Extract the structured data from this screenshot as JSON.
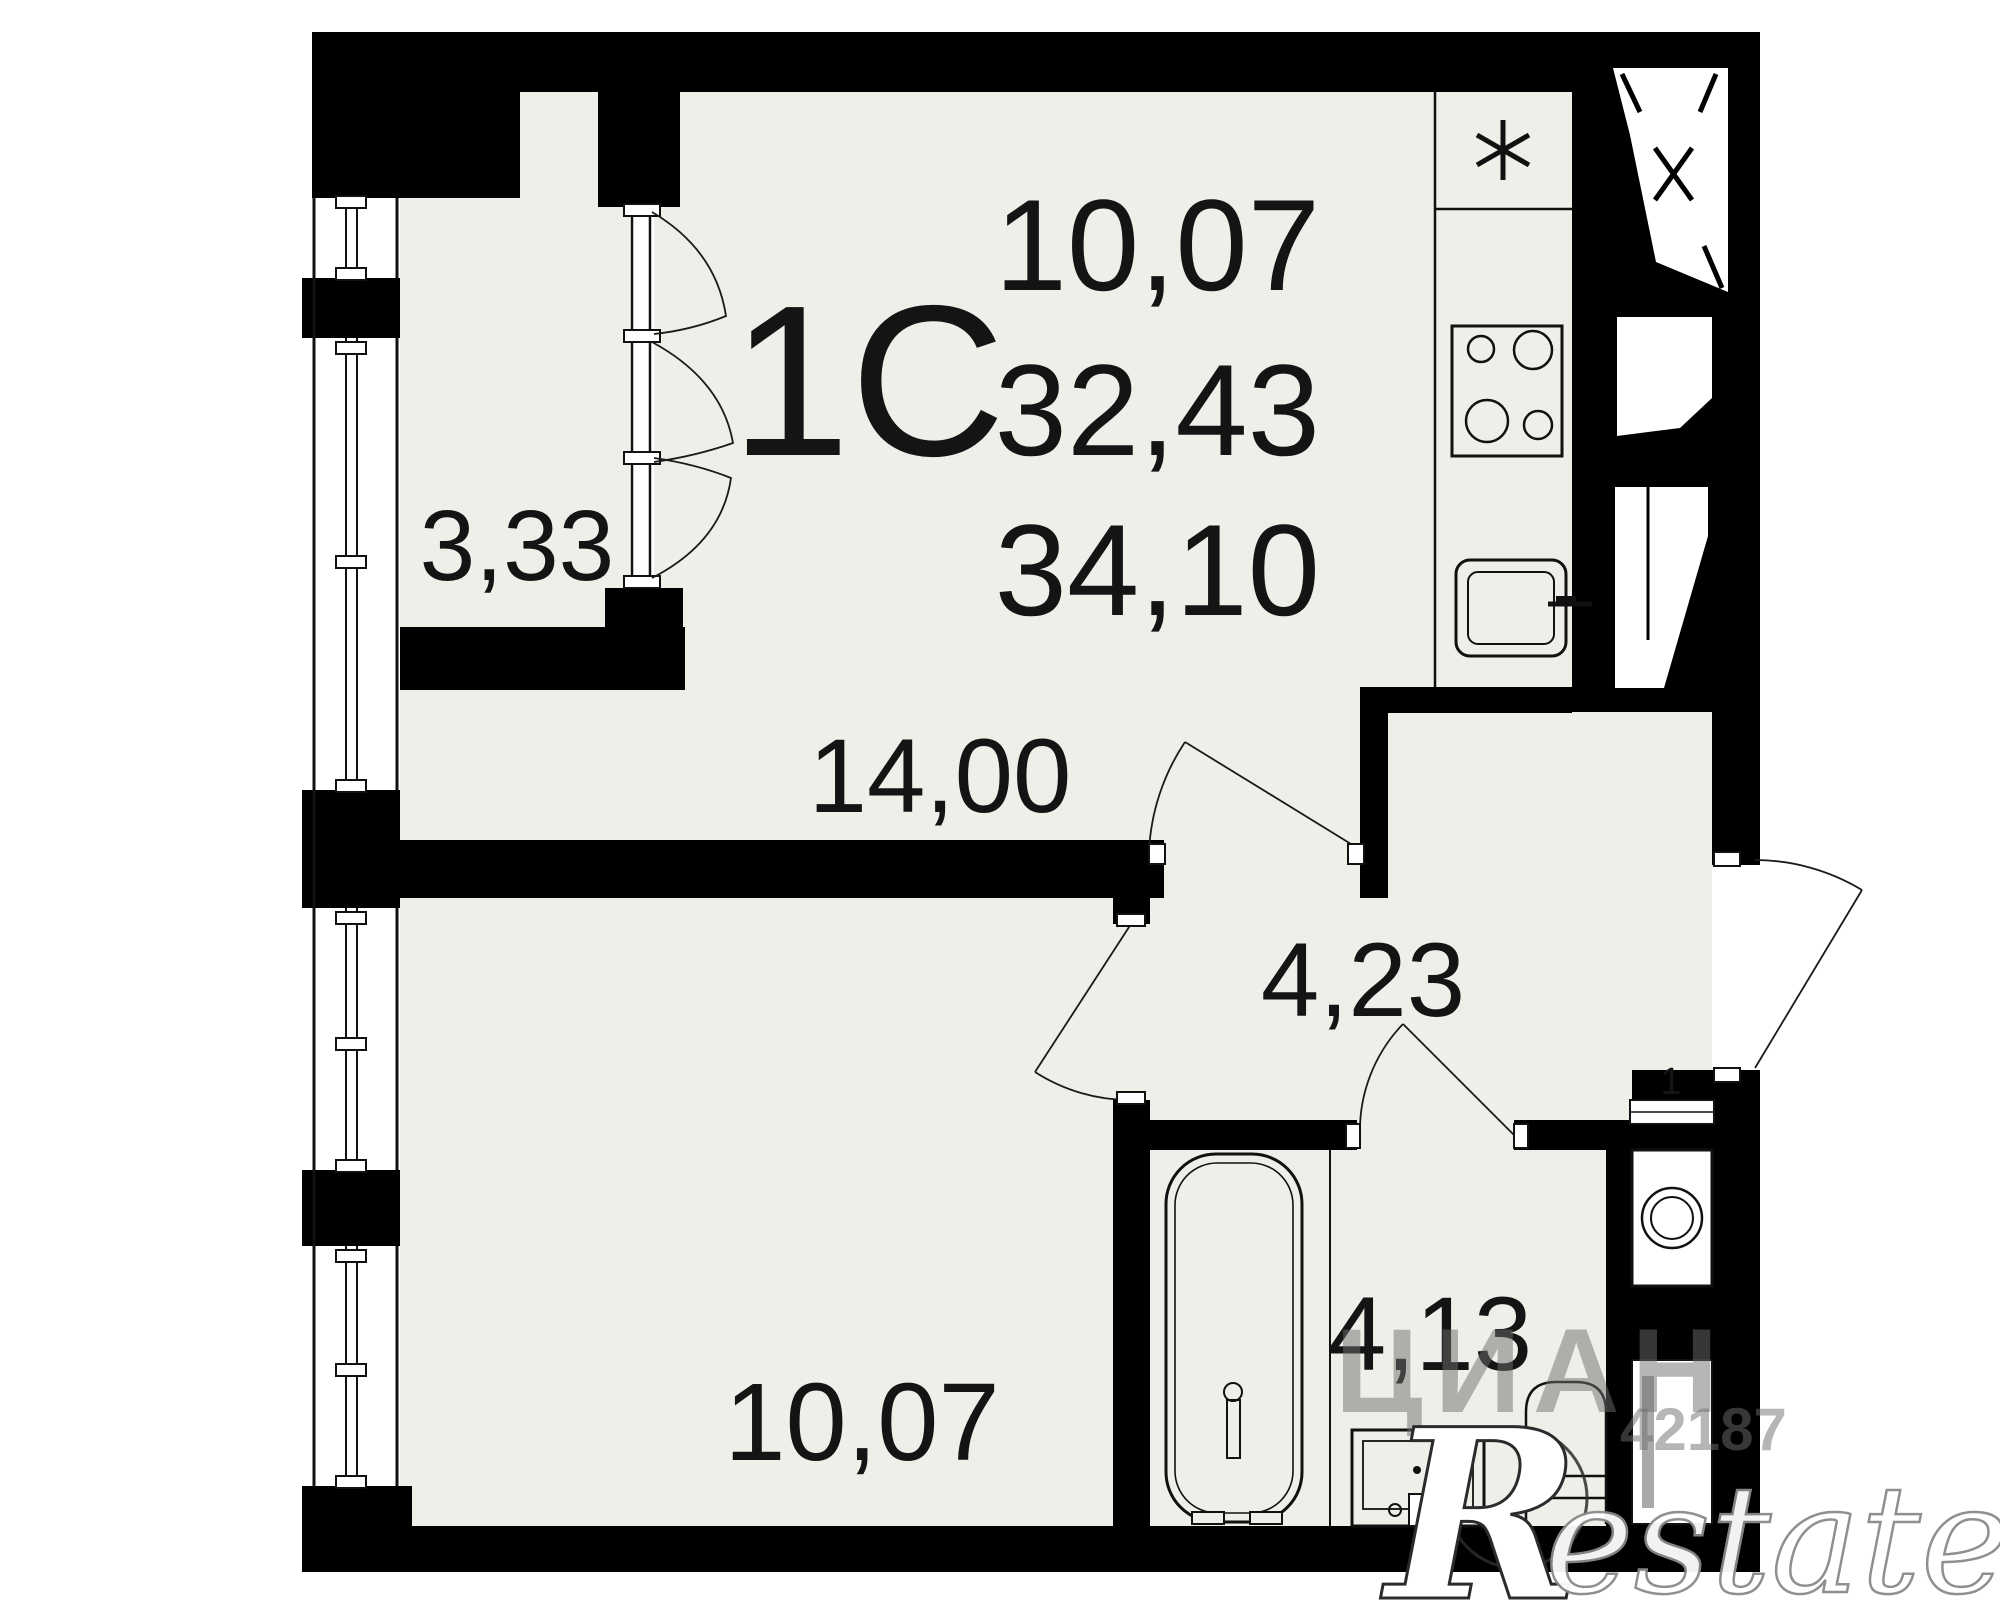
{
  "plan": {
    "unit_type": "1С",
    "areas": {
      "living": "10,07",
      "apartment": "32,43",
      "total": "34,10"
    },
    "rooms": [
      {
        "name": "loggia",
        "area": "3,33"
      },
      {
        "name": "kitchen-living-room",
        "area": "14,00"
      },
      {
        "name": "hallway",
        "area": "4,23"
      },
      {
        "name": "room",
        "area": "10,07"
      },
      {
        "name": "bathroom",
        "area": "4,13"
      }
    ],
    "door_mark": "1",
    "icons": {
      "fridge": "asterisk-star",
      "stove": "four-burner-circles",
      "kitchen_sink": "rounded-square-basin",
      "bathtub": "rounded-tub",
      "washbasin": "square-basin",
      "toilet": "round-top-bowl",
      "washing_machine": "drum-circle",
      "vent_shaft": "white-polygon-with-x"
    },
    "colors": {
      "wall": "#000000",
      "floor": "#f0eee8",
      "line": "#1a1a1a"
    }
  },
  "watermarks": {
    "portal": "ЦИАН",
    "listing_id": "42187",
    "brand_initial": "R",
    "brand_suffix": "estate"
  }
}
